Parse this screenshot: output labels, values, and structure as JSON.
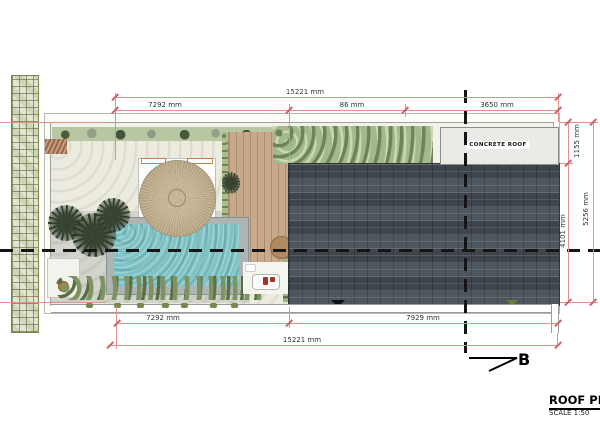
{
  "title_block": {
    "title": "ROOF PLAN",
    "scale": "SCALE 1:50"
  },
  "section_marker": {
    "label": "B"
  },
  "annotations": {
    "concrete_roof": "CONCRETE ROOF"
  },
  "dimensions": {
    "top_total": "15221 mm",
    "top_seg_left": "7292 mm",
    "top_seg_mid": "86 mm",
    "top_seg_right": "3650 mm",
    "bottom_seg_left": "7292 mm",
    "bottom_seg_right": "7929 mm",
    "bottom_total": "15221 mm",
    "right_top": "1155 mm",
    "right_bottom": "4101 mm",
    "right_total": "5256 mm"
  },
  "colors": {
    "dimension_line": "#e59090",
    "dimension_tick": "#d06565",
    "section_line": "#151515",
    "tile_roof": "#454d54",
    "pool_water": "#7fc3c6",
    "hedge_green": "#b7c7a2",
    "deck_wood": "#c7a98c",
    "thatch_roof": "#c3b091",
    "concrete_roof": "#eaeae7",
    "boundary_wall": "#d9ddc6"
  }
}
